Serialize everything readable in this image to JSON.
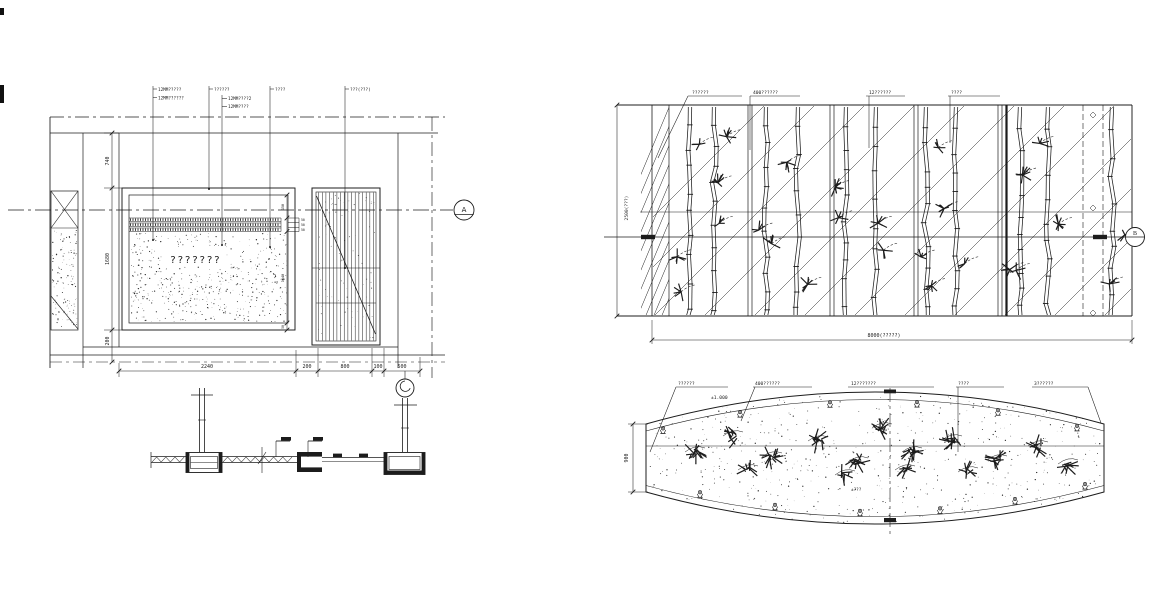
{
  "meta": {
    "background": "#ffffff",
    "ink": "#1c1c1c"
  },
  "wall_elevation": {
    "leader_labels": {
      "l1a": "12MM?????",
      "l1b": "12MM??????",
      "l2": "??????",
      "l2a": "12MM????2",
      "l2b": "12MM????",
      "l3": "????",
      "l4": "???(???)"
    },
    "panel_text": "???????",
    "dims": {
      "h_top": "740",
      "h_mid": "1680",
      "h_bot": "200",
      "w1": "2240",
      "w2": "200",
      "w3": "800",
      "w4": "100",
      "w5": "500",
      "r_top": "150",
      "r_s1": "50",
      "r_s2": "50",
      "r_s3": "50",
      "r_mid": "1540",
      "r_bot": "50"
    },
    "section_marker": "A"
  },
  "bamboo_elevation": {
    "leader_labels": {
      "l1": "??????",
      "l2": "400??????",
      "l3": "12??????",
      "l4": "????"
    },
    "dims": {
      "height": "2500(???)",
      "width": "8000(?????)"
    },
    "section_marker": "B"
  },
  "planter_plan": {
    "leader_labels": {
      "m1": "??????",
      "m2": "400??????",
      "m3": "12???????",
      "m4": "????",
      "m5": "3??????"
    },
    "level": "±1.000",
    "note": "±???",
    "dims": {
      "height": "900"
    }
  }
}
